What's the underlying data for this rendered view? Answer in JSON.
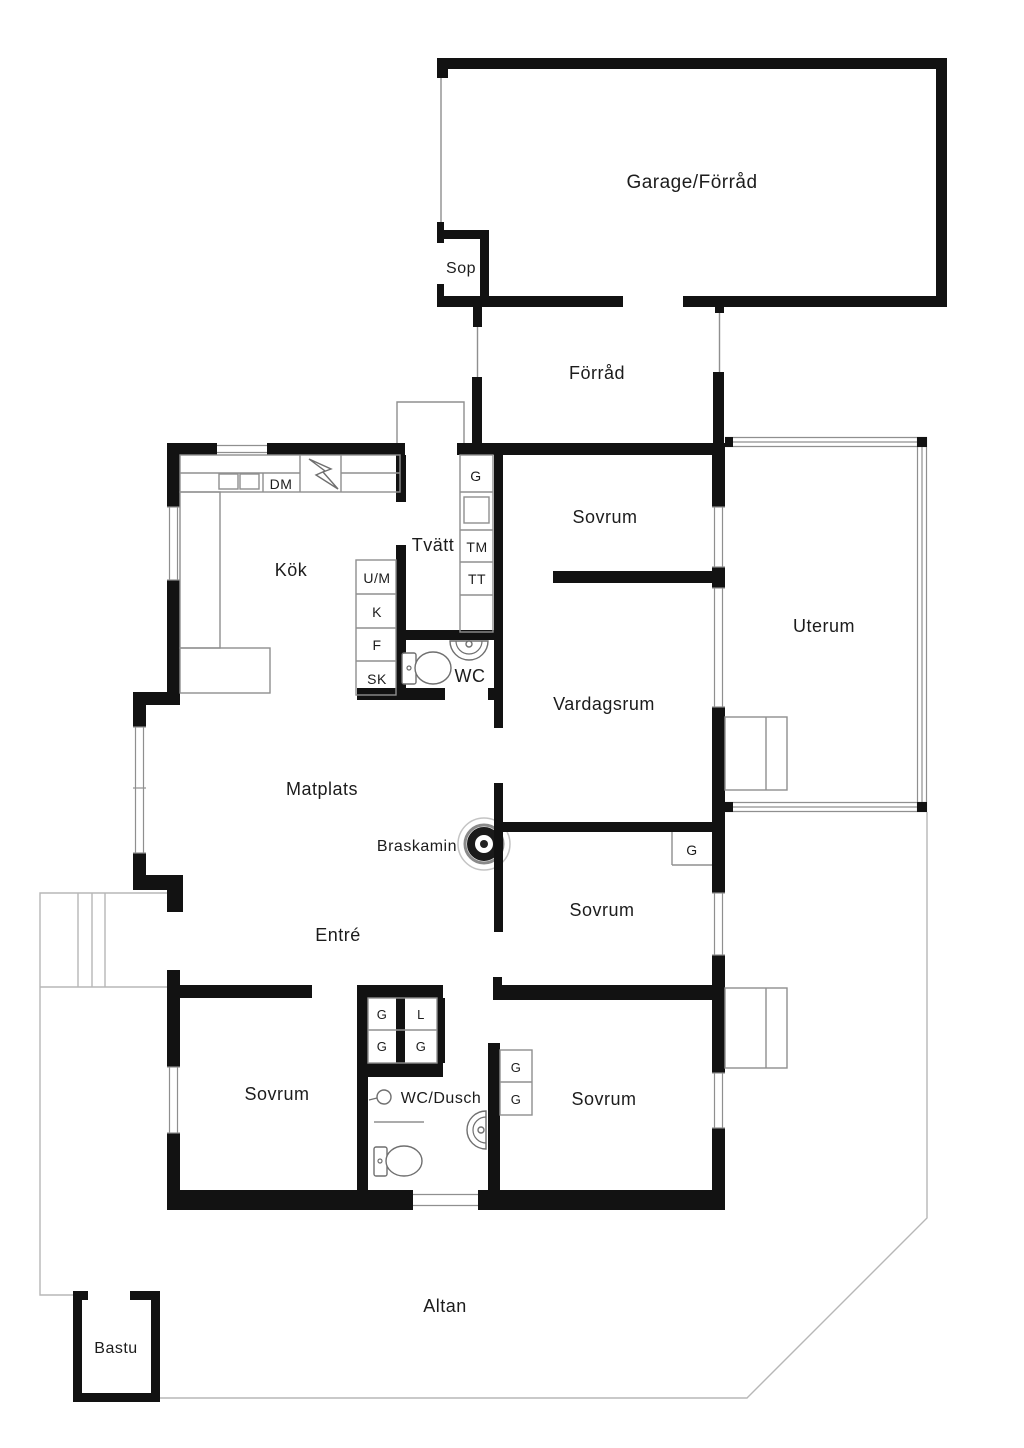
{
  "rooms": {
    "garage": "Garage/Förråd",
    "sop": "Sop",
    "forrad": "Förråd",
    "kok": "Kök",
    "tvatt": "Tvätt",
    "wc": "WC",
    "sovrum_top": "Sovrum",
    "uterum": "Uterum",
    "vardagsrum": "Vardagsrum",
    "matplats": "Matplats",
    "entre": "Entré",
    "sovrum_mid": "Sovrum",
    "sovrum_bottom_left": "Sovrum",
    "wc_dusch": "WC/Dusch",
    "sovrum_bottom_right": "Sovrum",
    "altan": "Altan",
    "bastu": "Bastu"
  },
  "features": {
    "braskamin": "Braskamin"
  },
  "cabinets": {
    "dm": "DM",
    "tvatt_g": "G",
    "tm": "TM",
    "tt": "TT",
    "um": "U/M",
    "k": "K",
    "f": "F",
    "sk": "SK",
    "sovrum_mid_g": "G",
    "hall_g1": "G",
    "hall_l": "L",
    "hall_g2": "G",
    "hall_g3": "G",
    "sovrum_br_g1": "G",
    "sovrum_br_g2": "G"
  },
  "colors": {
    "wall": "#121212",
    "thin_line": "#8f8f8f",
    "deck_line": "#b7b7b7",
    "text": "#1c1c1c",
    "background": "#ffffff"
  }
}
